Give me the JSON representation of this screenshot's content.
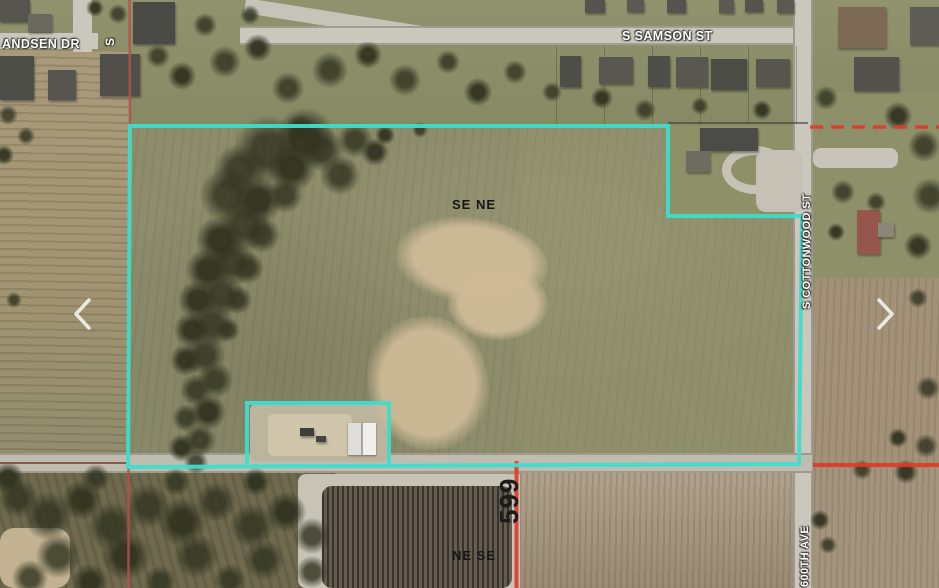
{
  "image_type": "aerial-parcel-map",
  "labels": {
    "andsen_dr": "ANDSEN DR",
    "side_street_stub": "S",
    "samson_st": "S SAMSON ST",
    "cottonwood_st": "S COTTONWOOD ST",
    "ave_600th": "600TH AVE",
    "quarter_se_ne": "SE NE",
    "quarter_ne_se": "NE SE",
    "road_599": "599"
  },
  "colors": {
    "boundary": "#3fdccb",
    "section_red": "#e2392a",
    "section_red_muted": "#b5524a",
    "section_red_dark": "#7c4134"
  },
  "nav": {
    "prev_icon": "chevron-left",
    "next_icon": "chevron-right"
  }
}
